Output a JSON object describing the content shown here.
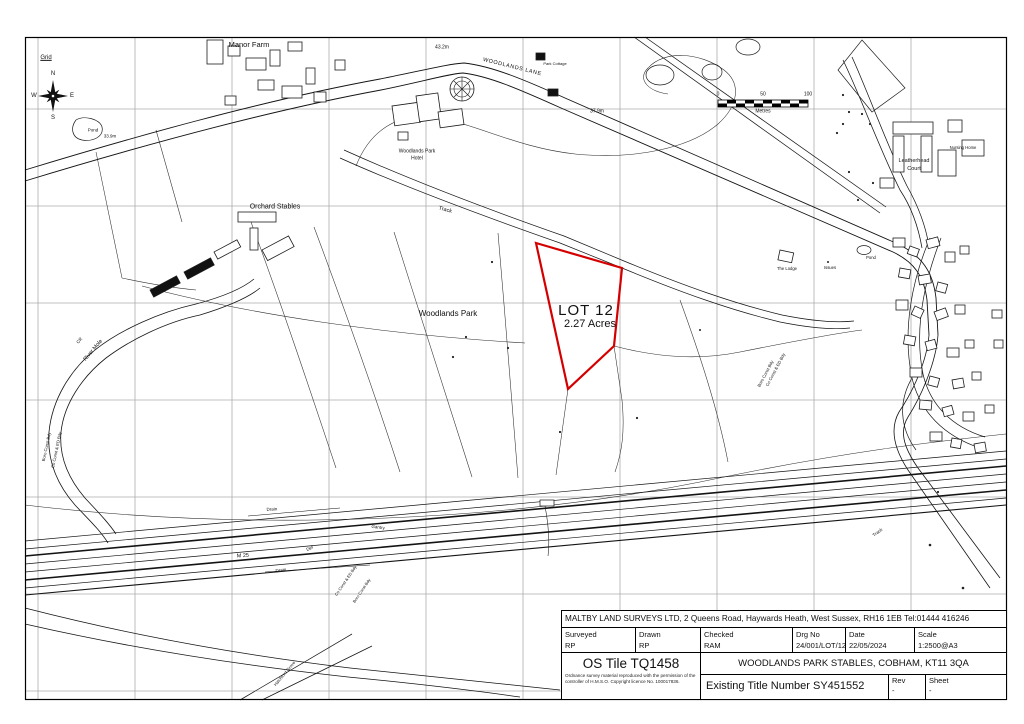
{
  "map": {
    "lot": {
      "name": "LOT 12",
      "area": "2.27 Acres",
      "outline_color": "#d40000"
    },
    "compass": {
      "grid_label": "Grid",
      "n": "N",
      "e": "E",
      "s": "S",
      "w": "W"
    },
    "scalebar": {
      "ticks": [
        "0",
        "50",
        "100"
      ],
      "unit": "Metres"
    },
    "labels": [
      {
        "text": "Manor Farm"
      },
      {
        "text": "Pond"
      },
      {
        "text": "33.9m"
      },
      {
        "text": "43.2m"
      },
      {
        "text": "WOODLANDS LANE"
      },
      {
        "text": "Park Cottage"
      },
      {
        "text": "Woodlands Park"
      },
      {
        "text": "Hotel"
      },
      {
        "text": "37.9m"
      },
      {
        "text": "Orchard Stables"
      },
      {
        "text": "Track"
      },
      {
        "text": "Woodlands Park"
      },
      {
        "text": "Leatherhead"
      },
      {
        "text": "Court"
      },
      {
        "text": "Nursing Home"
      },
      {
        "text": "The Lodge"
      },
      {
        "text": "Issues"
      },
      {
        "text": "Pond"
      },
      {
        "text": "River Mole"
      },
      {
        "text": "CR"
      },
      {
        "text": "Boro Const Bdy"
      },
      {
        "text": "Co Const & ED Bdy"
      },
      {
        "text": "Boro Const Bdy"
      },
      {
        "text": "Co Const & ED Bdy"
      },
      {
        "text": "M 25"
      },
      {
        "text": "Drain"
      },
      {
        "text": "Gantry"
      },
      {
        "text": "Def"
      },
      {
        "text": "Drain"
      },
      {
        "text": "Co Const & ED Bdy"
      },
      {
        "text": "Boro Const Bdy"
      },
      {
        "text": "Hatchford Grove"
      },
      {
        "text": "Track"
      }
    ]
  },
  "title_block": {
    "company_line": "MALTBY LAND SURVEYS LTD, 2 Queens Road, Haywards Heath, West Sussex,  RH16 1EB  Tel:01444 416246",
    "fields": [
      {
        "label": "Surveyed",
        "value": "RP"
      },
      {
        "label": "Drawn",
        "value": "RP"
      },
      {
        "label": "Checked",
        "value": "RAM"
      },
      {
        "label": "Drg No",
        "value": "24/001/LOT/12"
      },
      {
        "label": "Date",
        "value": "22/05/2024"
      },
      {
        "label": "Scale",
        "value": "1:2500@A3"
      }
    ],
    "os_tile": "OS Tile TQ1458",
    "copyright": "Ordnance survey material reproduced with the permission of the controller of H.M.S.O. Copyright licence No. 100017836.",
    "site": "WOODLANDS PARK STABLES, COBHAM, KT11 3QA",
    "title_number": "Existing Title Number SY451552",
    "rev_label": "Rev",
    "rev_value": "-",
    "sheet_label": "Sheet",
    "sheet_value": "-"
  }
}
